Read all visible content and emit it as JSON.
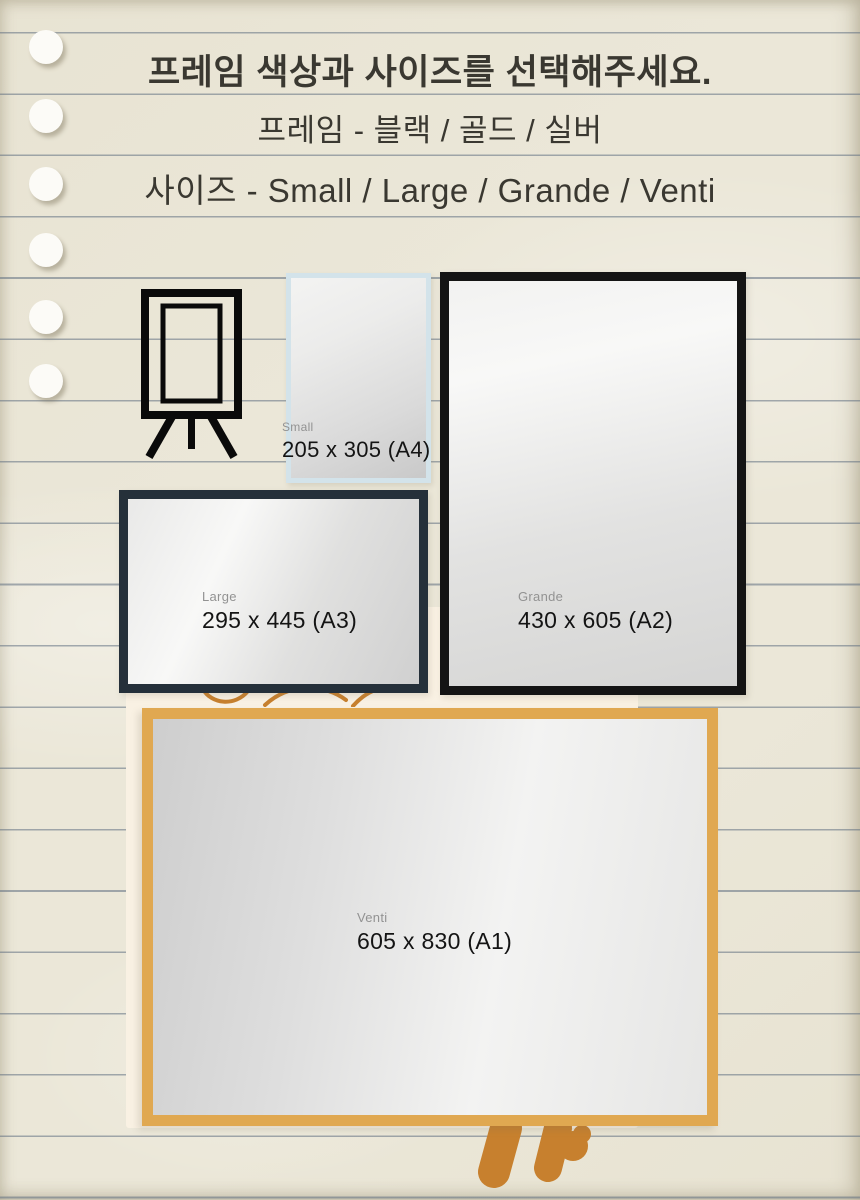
{
  "header": {
    "title": "프레임 색상과 사이즈를 선택해주세요.",
    "frame_colors_line": "프레임 - 블랙 / 골드 / 실버",
    "sizes_line": "사이즈 - Small / Large / Grande / Venti"
  },
  "frames": [
    {
      "size_name": "Small",
      "dimensions": "205 x 305 (A4)",
      "frame_color": "#d3e3ea"
    },
    {
      "size_name": "Large",
      "dimensions": "295 x 445 (A3)",
      "frame_color": "#25303a"
    },
    {
      "size_name": "Grande",
      "dimensions": "430 x 605 (A2)",
      "frame_color": "#141414"
    },
    {
      "size_name": "Venti",
      "dimensions": "605 x 830 (A1)",
      "frame_color": "#e0a851"
    }
  ],
  "icons": {
    "easel": "easel-icon",
    "doodle_arcs": "orange-doodle-arcs",
    "doodle_legs": "orange-easel-legs-doodle"
  },
  "colors": {
    "paper": "#ebe7d8",
    "ruled_line": "#5f6e80",
    "title_text": "#3a3831",
    "size_name_text": "#929292",
    "dimension_text": "#141414",
    "doodle_orange": "#c7802e",
    "canvas_sheet": "#f9f1e3"
  }
}
